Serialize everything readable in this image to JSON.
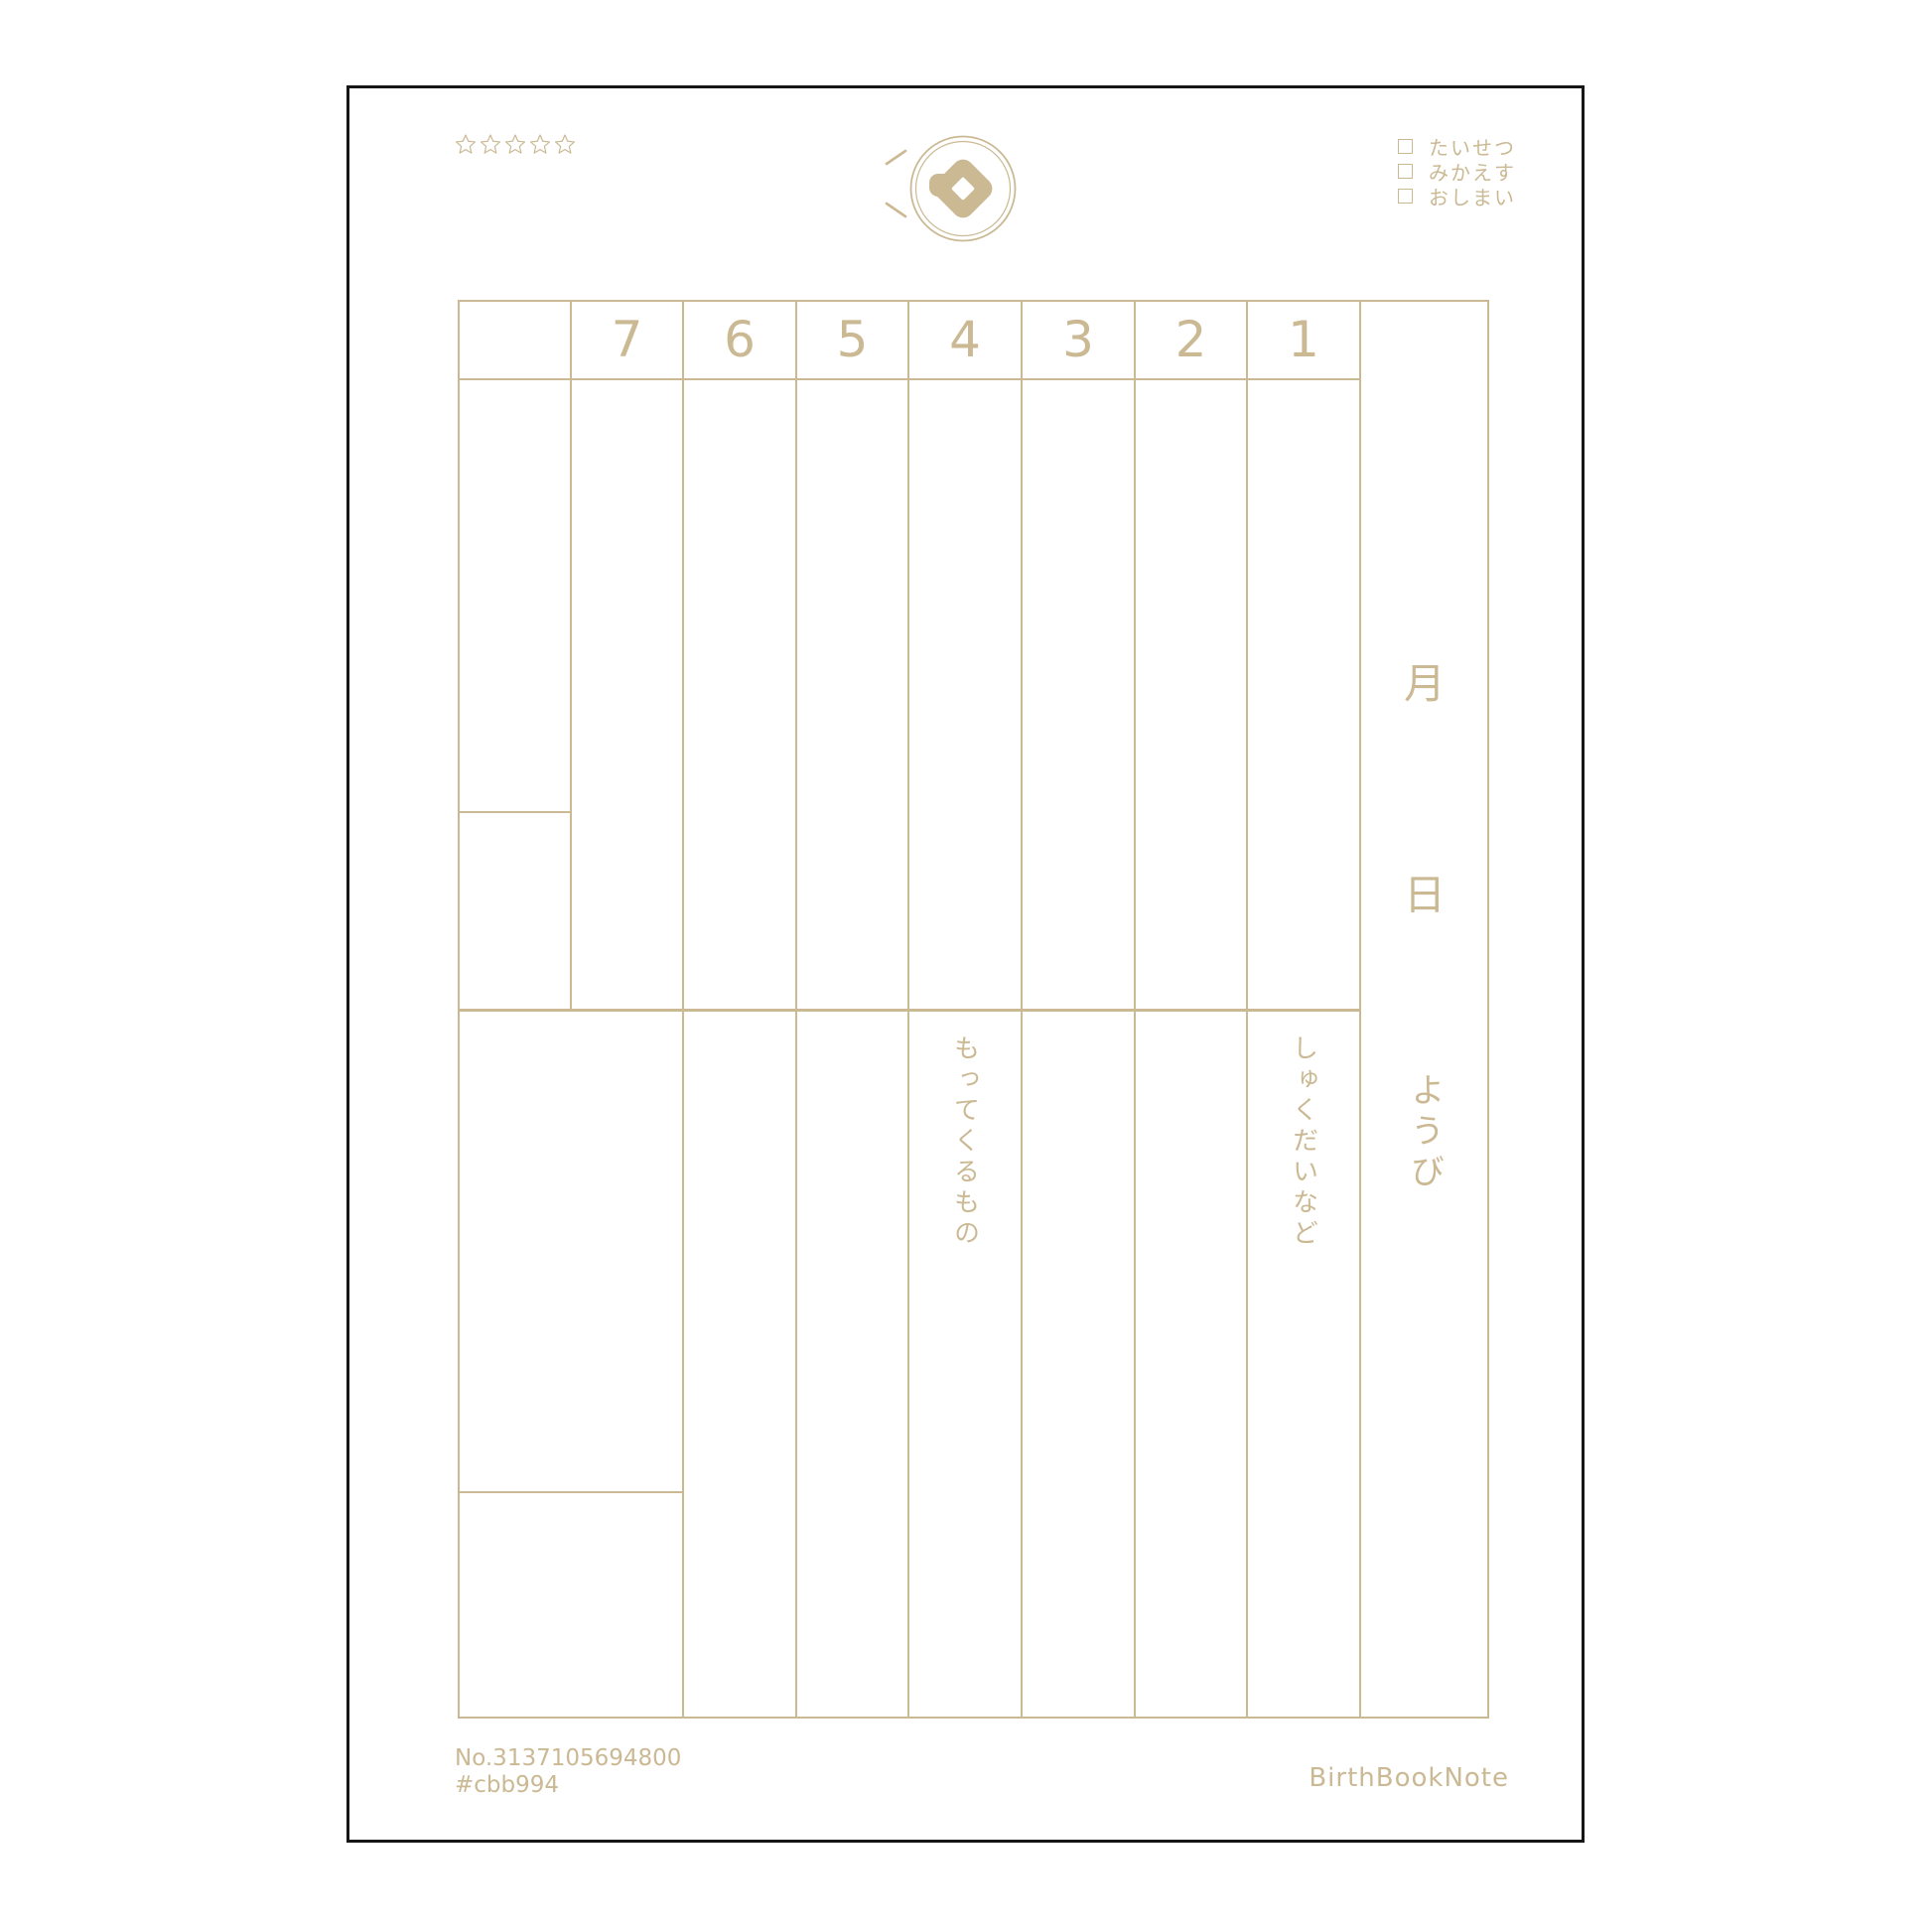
{
  "theme": {
    "accent": "#cbb994",
    "sheet_border": "#161616",
    "background": "#ffffff"
  },
  "header": {
    "stars": {
      "icon": "star-outline-icon",
      "count": 5
    },
    "logo": {
      "icon": "diamond-seal-logo-icon"
    },
    "checklist": [
      {
        "label": "たいせつ"
      },
      {
        "label": "みかえす"
      },
      {
        "label": "おしまい"
      }
    ]
  },
  "table": {
    "period_headers": [
      "7",
      "6",
      "5",
      "4",
      "3",
      "2",
      "1"
    ],
    "date_column": {
      "month_label": "月",
      "day_label": "日",
      "weekday_label": "ようび"
    },
    "bring_column_label": "もってくるもの",
    "homework_column_label": "しゅくだいなど"
  },
  "footer": {
    "serial_number": "No.3137105694800",
    "color_code": "#cbb994",
    "brand": "BirthBookNote"
  }
}
